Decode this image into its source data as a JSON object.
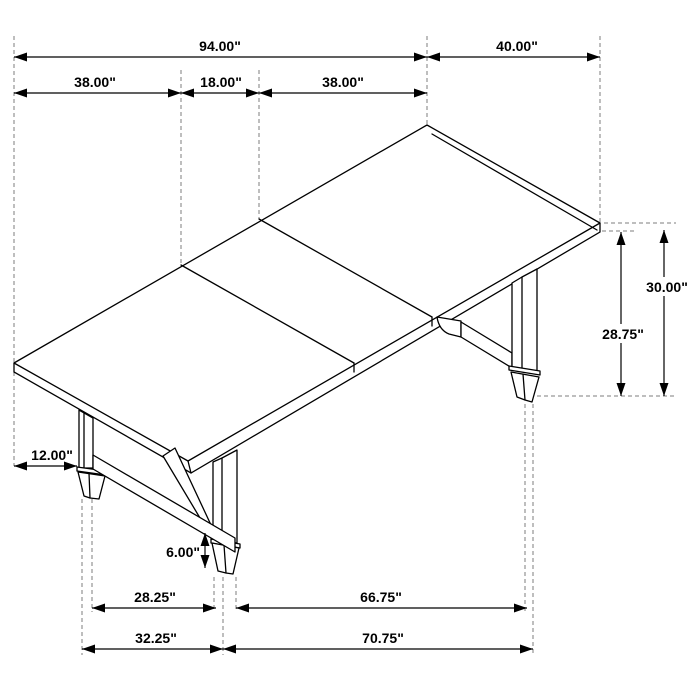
{
  "diagram": {
    "title": "dining-table-dimension-drawing",
    "line_color": "#000000",
    "extension_line_color": "#7c7c7c",
    "background": "#ffffff",
    "dimensions": {
      "top_length_total": "94.00\"",
      "top_width": "40.00\"",
      "leaf_left": "38.00\"",
      "leaf_center": "18.00\"",
      "leaf_right": "38.00\"",
      "table_height": "30.00\"",
      "underside_height": "28.75\"",
      "end_overhang": "12.00\"",
      "stretcher_clearance": "6.00\"",
      "foot_span_inner": "28.25\"",
      "foot_span_outer": "32.25\"",
      "foot_gap_long": "66.75\"",
      "base_span_long": "70.75\""
    }
  }
}
